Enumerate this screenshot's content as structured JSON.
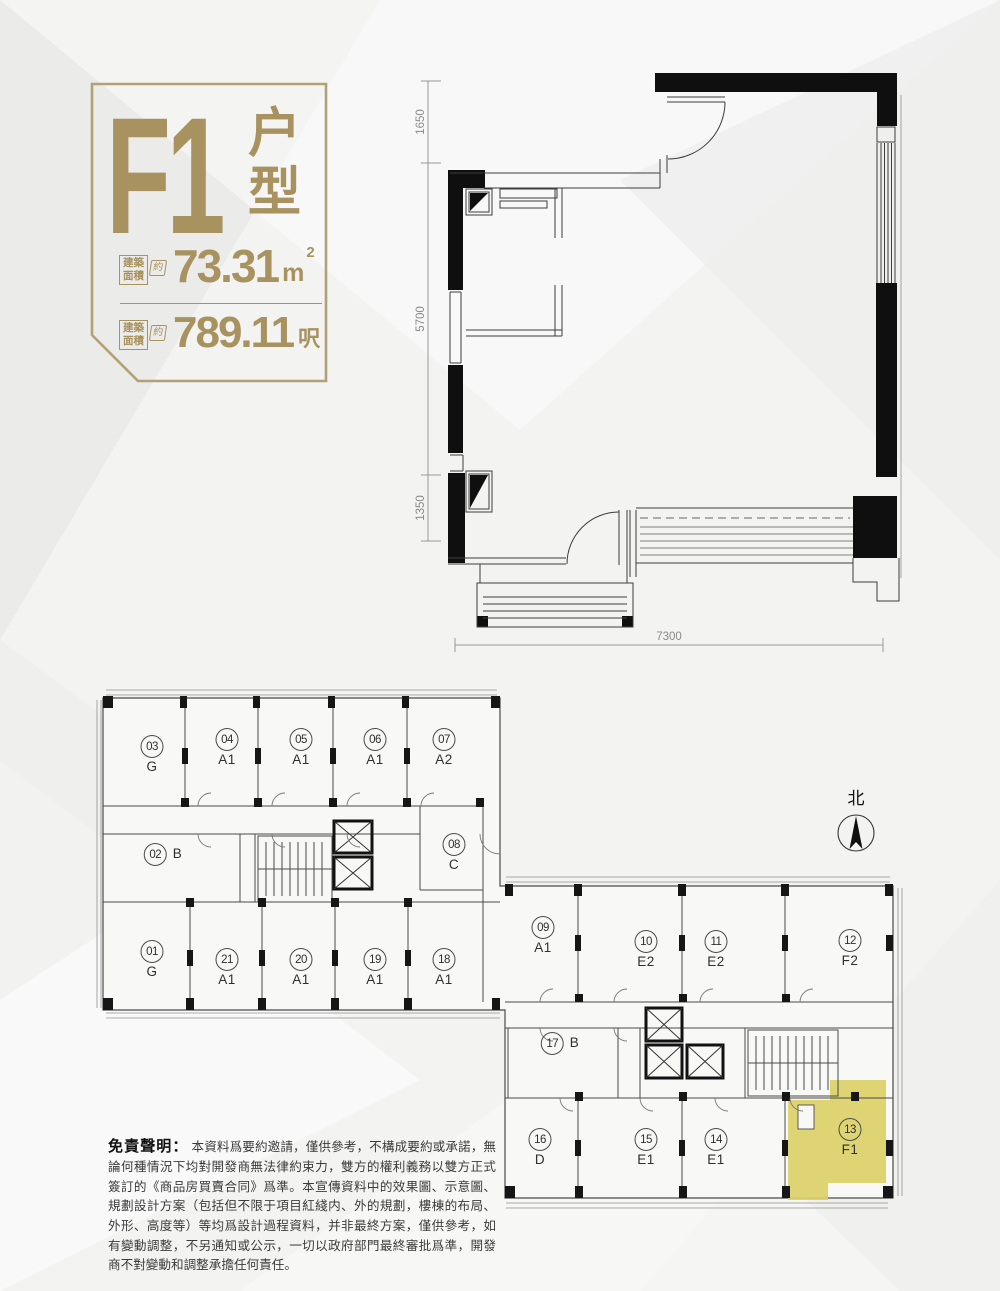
{
  "title_block": {
    "unit_code": "F1",
    "type_chars": [
      "户",
      "型"
    ],
    "accent_color": "#a8925f",
    "areas": [
      {
        "label1": "建築",
        "label2": "面積",
        "approx": "約",
        "value": "73.31",
        "unit": "m",
        "sup": "2"
      },
      {
        "label1": "建築",
        "label2": "面積",
        "approx": "約",
        "value": "789.11",
        "unit": "呎",
        "sup": ""
      }
    ]
  },
  "floor_plan": {
    "left_dims": [
      "1650",
      "5700",
      "1350"
    ],
    "bottom_dim": "7300"
  },
  "key_plan": {
    "north_label": "北",
    "highlight_color": "#ddd169",
    "units": [
      {
        "no": "01",
        "type": "G"
      },
      {
        "no": "02",
        "type": "B"
      },
      {
        "no": "03",
        "type": "G"
      },
      {
        "no": "04",
        "type": "A1"
      },
      {
        "no": "05",
        "type": "A1"
      },
      {
        "no": "06",
        "type": "A1"
      },
      {
        "no": "07",
        "type": "A2"
      },
      {
        "no": "08",
        "type": "C"
      },
      {
        "no": "09",
        "type": "A1"
      },
      {
        "no": "10",
        "type": "E2"
      },
      {
        "no": "11",
        "type": "E2"
      },
      {
        "no": "12",
        "type": "F2"
      },
      {
        "no": "13",
        "type": "F1"
      },
      {
        "no": "14",
        "type": "E1"
      },
      {
        "no": "15",
        "type": "E1"
      },
      {
        "no": "16",
        "type": "D"
      },
      {
        "no": "17",
        "type": "B"
      },
      {
        "no": "18",
        "type": "A1"
      },
      {
        "no": "19",
        "type": "A1"
      },
      {
        "no": "20",
        "type": "A1"
      },
      {
        "no": "21",
        "type": "A1"
      }
    ]
  },
  "disclaimer": {
    "heading": "免責聲明：",
    "body": "本資料爲要約邀請，僅供參考，不構成要約或承諾，無論何種情況下均對開發商無法律約束力，雙方的權利義務以雙方正式簽訂的《商品房買賣合同》爲準。本宣傳資料中的效果圖、示意圖、規劃設計方案（包括但不限于項目紅綫内、外的規劃，樓棟的布局、外形、高度等）等均爲設計過程資料，并非最終方案，僅供參考，如有變動調整，不另通知或公示，一切以政府部門最終審批爲準，開發商不對變動和調整承擔任何責任。"
  }
}
